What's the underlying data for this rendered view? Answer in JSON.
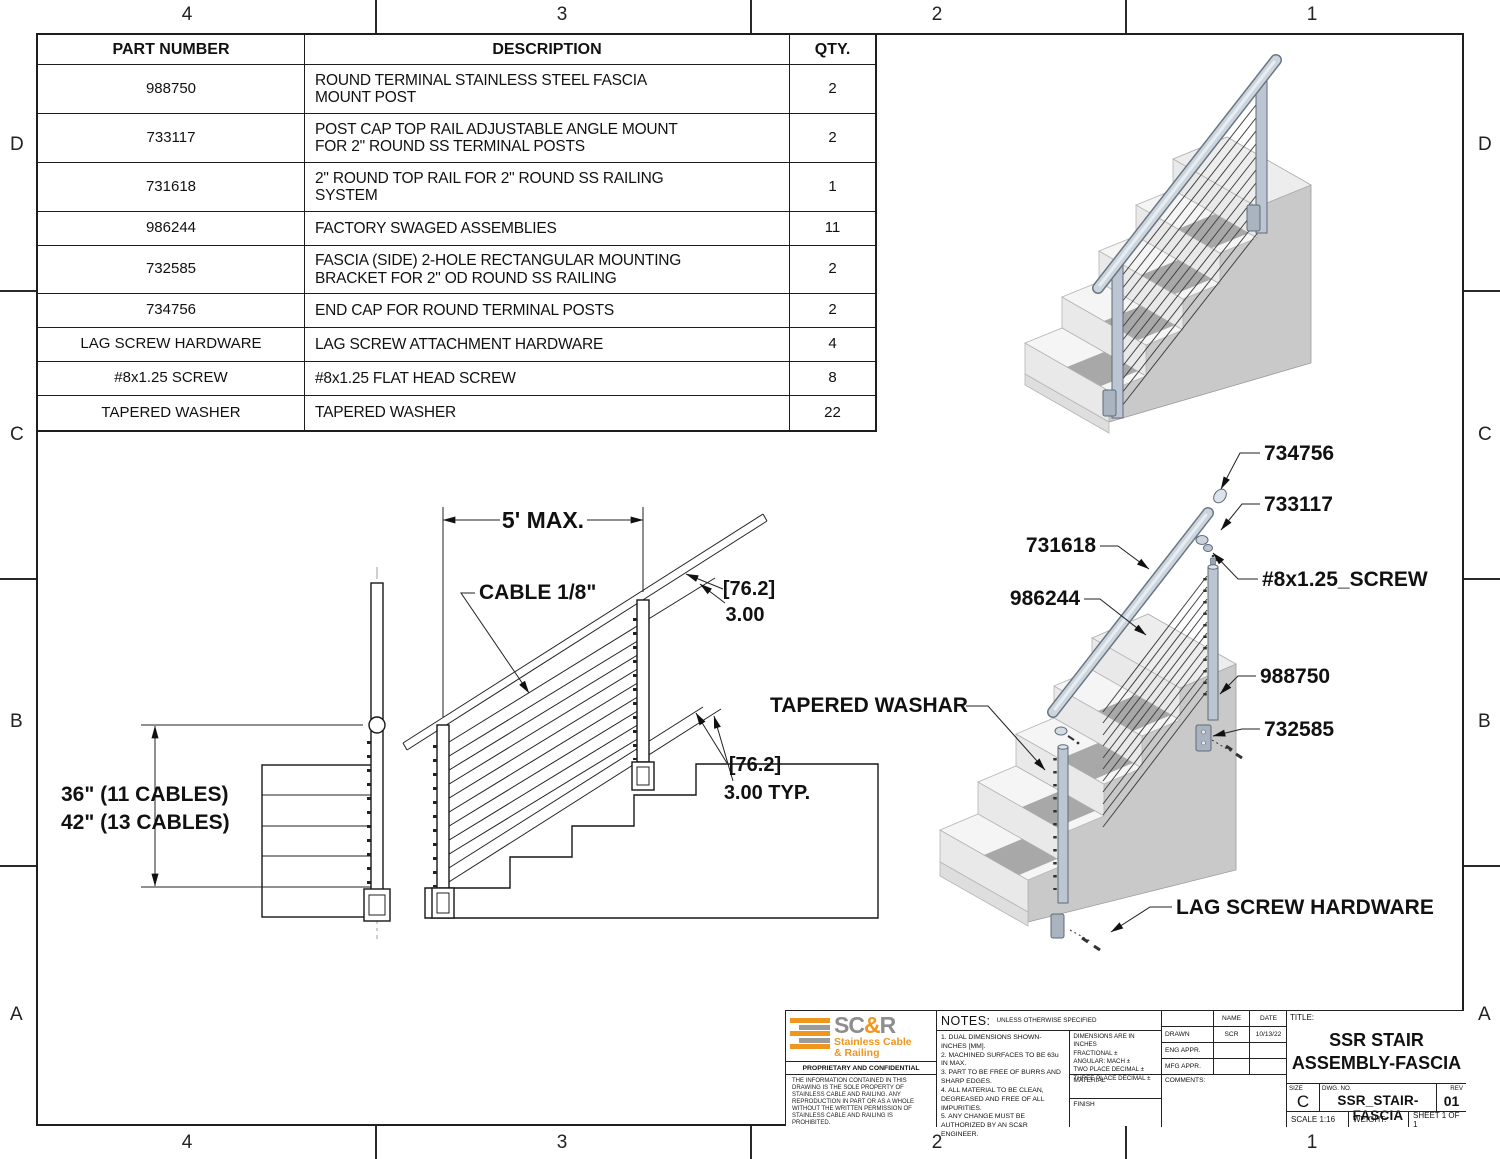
{
  "sheet": {
    "zones": {
      "top": [
        "4",
        "3",
        "2",
        "1"
      ],
      "bottom": [
        "4",
        "3",
        "2",
        "1"
      ],
      "left": [
        "D",
        "C",
        "B",
        "A"
      ],
      "right": [
        "D",
        "C",
        "B",
        "A"
      ]
    }
  },
  "parts_table": {
    "headers": [
      "PART NUMBER",
      "DESCRIPTION",
      "QTY."
    ],
    "rows": [
      {
        "part": "988750",
        "description": "ROUND TERMINAL STAINLESS STEEL FASCIA\nMOUNT POST",
        "qty": "2"
      },
      {
        "part": "733117",
        "description": "POST CAP TOP RAIL ADJUSTABLE ANGLE MOUNT\nFOR 2\" ROUND SS TERMINAL POSTS",
        "qty": "2"
      },
      {
        "part": "731618",
        "description": "2\" ROUND TOP RAIL FOR 2\" ROUND SS RAILING\nSYSTEM",
        "qty": "1"
      },
      {
        "part": "986244",
        "description": "FACTORY SWAGED ASSEMBLIES",
        "qty": "11"
      },
      {
        "part": "732585",
        "description": "FASCIA (SIDE) 2-HOLE RECTANGULAR MOUNTING\nBRACKET FOR 2\" OD ROUND SS RAILING",
        "qty": "2"
      },
      {
        "part": "734756",
        "description": "END CAP FOR ROUND TERMINAL POSTS",
        "qty": "2"
      },
      {
        "part": "LAG SCREW HARDWARE",
        "description": "LAG SCREW ATTACHMENT HARDWARE",
        "qty": "4"
      },
      {
        "part": "#8x1.25 SCREW",
        "description": "#8x1.25 FLAT HEAD SCREW",
        "qty": "8"
      },
      {
        "part": "TAPERED WASHER",
        "description": "TAPERED WASHER",
        "qty": "22"
      }
    ]
  },
  "elevation": {
    "dim_span": "5' MAX.",
    "cable_label": "CABLE 1/8\"",
    "mm_upper": "[76.2]",
    "in_upper": "3.00",
    "mm_lower": "[76.2]",
    "in_lower": "3.00  TYP.",
    "height_line1": "36\" (11 CABLES)",
    "height_line2": "42\" (13 CABLES)"
  },
  "exploded": {
    "end_cap": "734756",
    "post_cap": "733117",
    "top_rail": "731618",
    "screw": "#8x1.25_SCREW",
    "swaged": "986244",
    "post": "988750",
    "bracket": "732585",
    "washer": "TAPERED WASHAR",
    "lag": "LAG SCREW HARDWARE"
  },
  "title_block": {
    "brand_sc": "SC",
    "brand_amp": "&",
    "brand_r": "R",
    "brand_line1": "Stainless Cable",
    "brand_line2": "& Railing",
    "brand_orange": "#F0961E",
    "brand_gray": "#8e8e8e",
    "proprietary_title": "PROPRIETARY AND CONFIDENTIAL",
    "proprietary_text": "THE INFORMATION CONTAINED IN THIS DRAWING IS THE SOLE PROPERTY OF STAINLESS CABLE AND RAILING. ANY REPRODUCTION IN PART OR AS A WHOLE WITHOUT THE WRITTEN PERMISSION OF STAINLESS CABLE AND RAILING IS PROHIBITED.",
    "notes_title": "NOTES:",
    "notes_subtitle": "UNLESS OTHERWISE SPECIFIED",
    "notes": [
      "1. DUAL DIMENSIONS SHOWN- INCHES [MM].",
      "2. MACHINED SURFACES TO BE 63u IN MAX.",
      "3. PART TO BE FREE OF BURRS AND SHARP EDGES.",
      "4. ALL MATERIAL TO BE CLEAN, DEGREASED AND FREE OF ALL IMPURITIES.",
      "5. ANY CHANGE MUST BE AUTHORIZED BY AN SC&R ENGINEER."
    ],
    "tolerances": [
      "DIMENSIONS ARE IN INCHES",
      "FRACTIONAL ±",
      "ANGULAR: MACH ±",
      "TWO PLACE DECIMAL ±",
      "THREE PLACE DECIMAL ±"
    ],
    "material_label": "MATERIAL",
    "finish_label": "FINISH",
    "name_header": "NAME",
    "date_header": "DATE",
    "drawn_label": "DRAWN",
    "drawn_name": "SCR",
    "drawn_date": "10/13/22",
    "eng_label": "ENG APPR.",
    "mfg_label": "MFG APPR.",
    "comments_label": "COMMENTS:",
    "title_label": "TITLE:",
    "title_line1": "SSR STAIR",
    "title_line2": "ASSEMBLY-FASCIA",
    "size_label": "SIZE",
    "size_value": "C",
    "dwg_label": "DWG.  NO.",
    "dwg_value": "SSR_STAIR-FASCIA",
    "rev_label": "REV",
    "rev_value": "01",
    "scale_text": "SCALE 1:16",
    "weight_text": "WEIGHT:",
    "sheet_text": "SHEET 1 OF 1"
  }
}
